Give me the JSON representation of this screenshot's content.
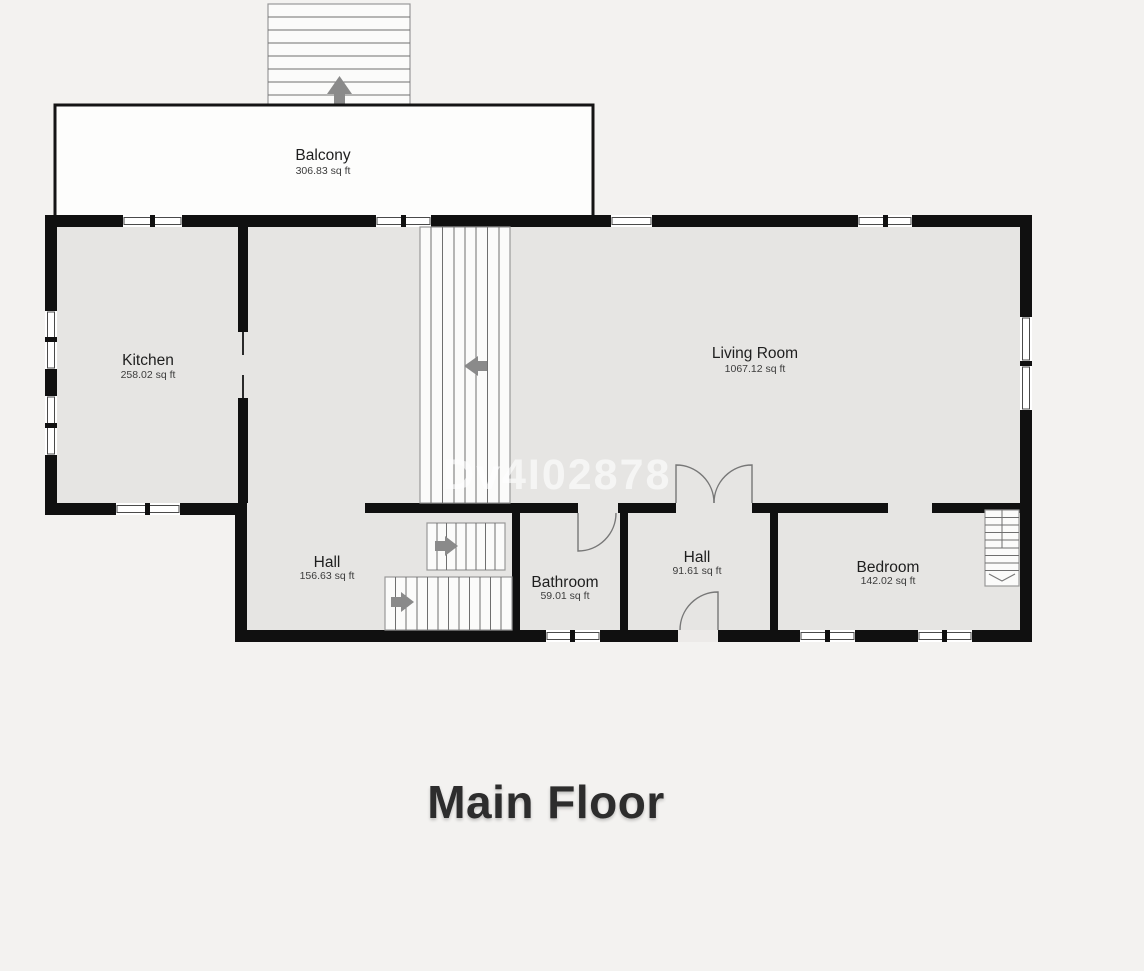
{
  "page": {
    "title": "Main Floor",
    "watermark": "Dv4I02878"
  },
  "rooms": {
    "balcony": {
      "name": "Balcony",
      "area": "306.83 sq ft"
    },
    "kitchen": {
      "name": "Kitchen",
      "area": "258.02 sq ft"
    },
    "living_room": {
      "name": "Living Room",
      "area": "1067.12 sq ft"
    },
    "hall_main": {
      "name": "Hall",
      "area": "156.63 sq ft"
    },
    "bathroom": {
      "name": "Bathroom",
      "area": "59.01 sq ft"
    },
    "hall_entry": {
      "name": "Hall",
      "area": "91.61 sq ft"
    },
    "bedroom": {
      "name": "Bedroom",
      "area": "142.02 sq ft"
    }
  },
  "colors": {
    "background": "#f3f2f0",
    "floor": "#e6e5e3",
    "wall": "#101010",
    "balcony_fill": "#fdfdfc",
    "stair_fill": "#fbfbfa",
    "arrow": "#8a8a8a",
    "door_line": "#777777",
    "watermark": "#ffffff",
    "label": "#1e1e1e",
    "area_label": "#3c3c3c",
    "title": "#2d2d2d"
  }
}
